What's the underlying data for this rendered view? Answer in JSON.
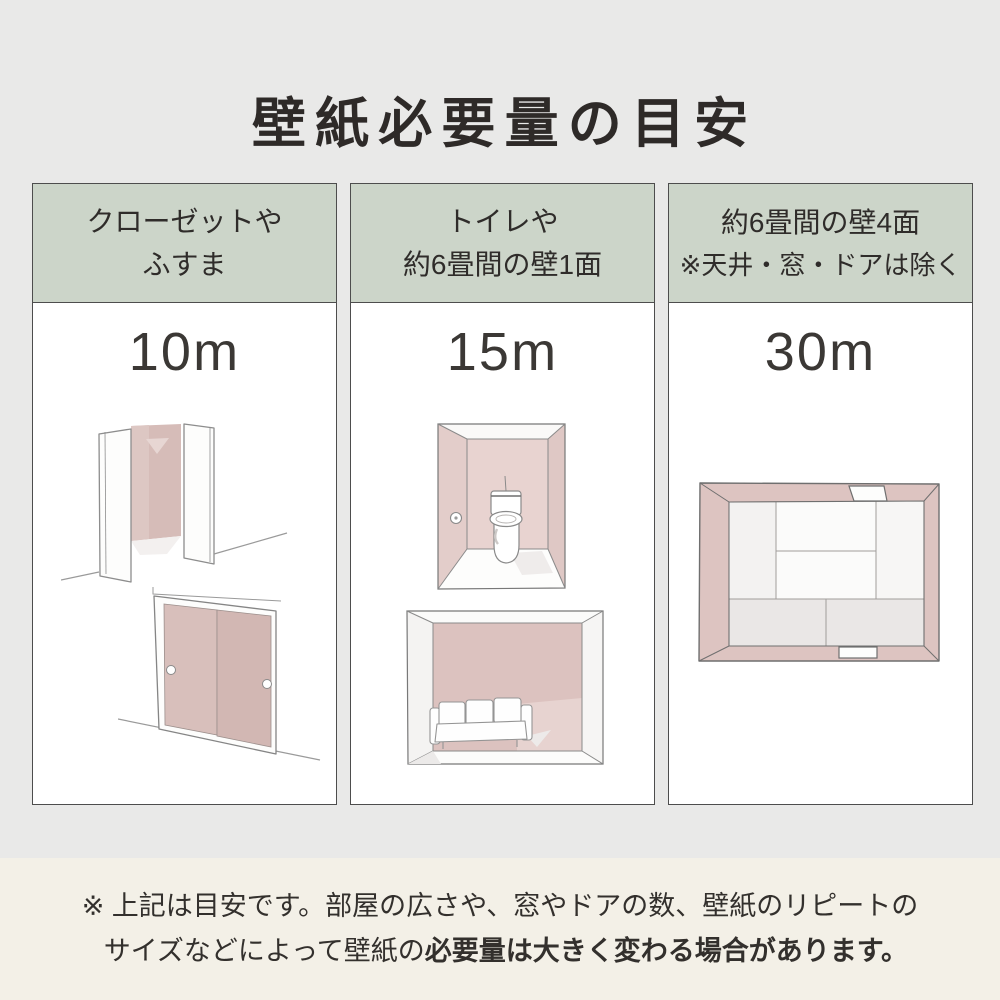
{
  "page": {
    "title": "壁紙必要量の目安"
  },
  "columns": [
    {
      "id": "closet-fusuma",
      "header_line1": "クローゼットや",
      "header_line2": "ふすま",
      "amount": "10m",
      "illustrations": [
        "open-closet",
        "fusuma-sliding-doors"
      ]
    },
    {
      "id": "toilet-one-wall",
      "header_line1": "トイレや",
      "header_line2": "約6畳間の壁1面",
      "amount": "15m",
      "illustrations": [
        "toilet-room",
        "living-room-accent-wall"
      ]
    },
    {
      "id": "six-mat-four-walls",
      "header_line1": "約6畳間の壁4面",
      "header_line2": "※天井・窓・ドアは除く",
      "amount": "30m",
      "illustrations": [
        "tatami-room-top-view"
      ]
    }
  ],
  "footer": {
    "note_line1": "※ 上記は目安です。部屋の広さや、窓やドアの数、壁紙のリピートの",
    "note_line2_normal": "サイズなどによって壁紙の",
    "note_line2_bold": "必要量は大きく変わる場合があります。"
  },
  "colors": {
    "background": "#e9e9e8",
    "footer_background": "#f3f0e7",
    "header_green": "#ccd5c9",
    "card_border": "#4d4d4d",
    "wallpaper_pink": "#d6bcb8",
    "wall_pink_light": "#e3cdca",
    "text": "#322f2c"
  }
}
